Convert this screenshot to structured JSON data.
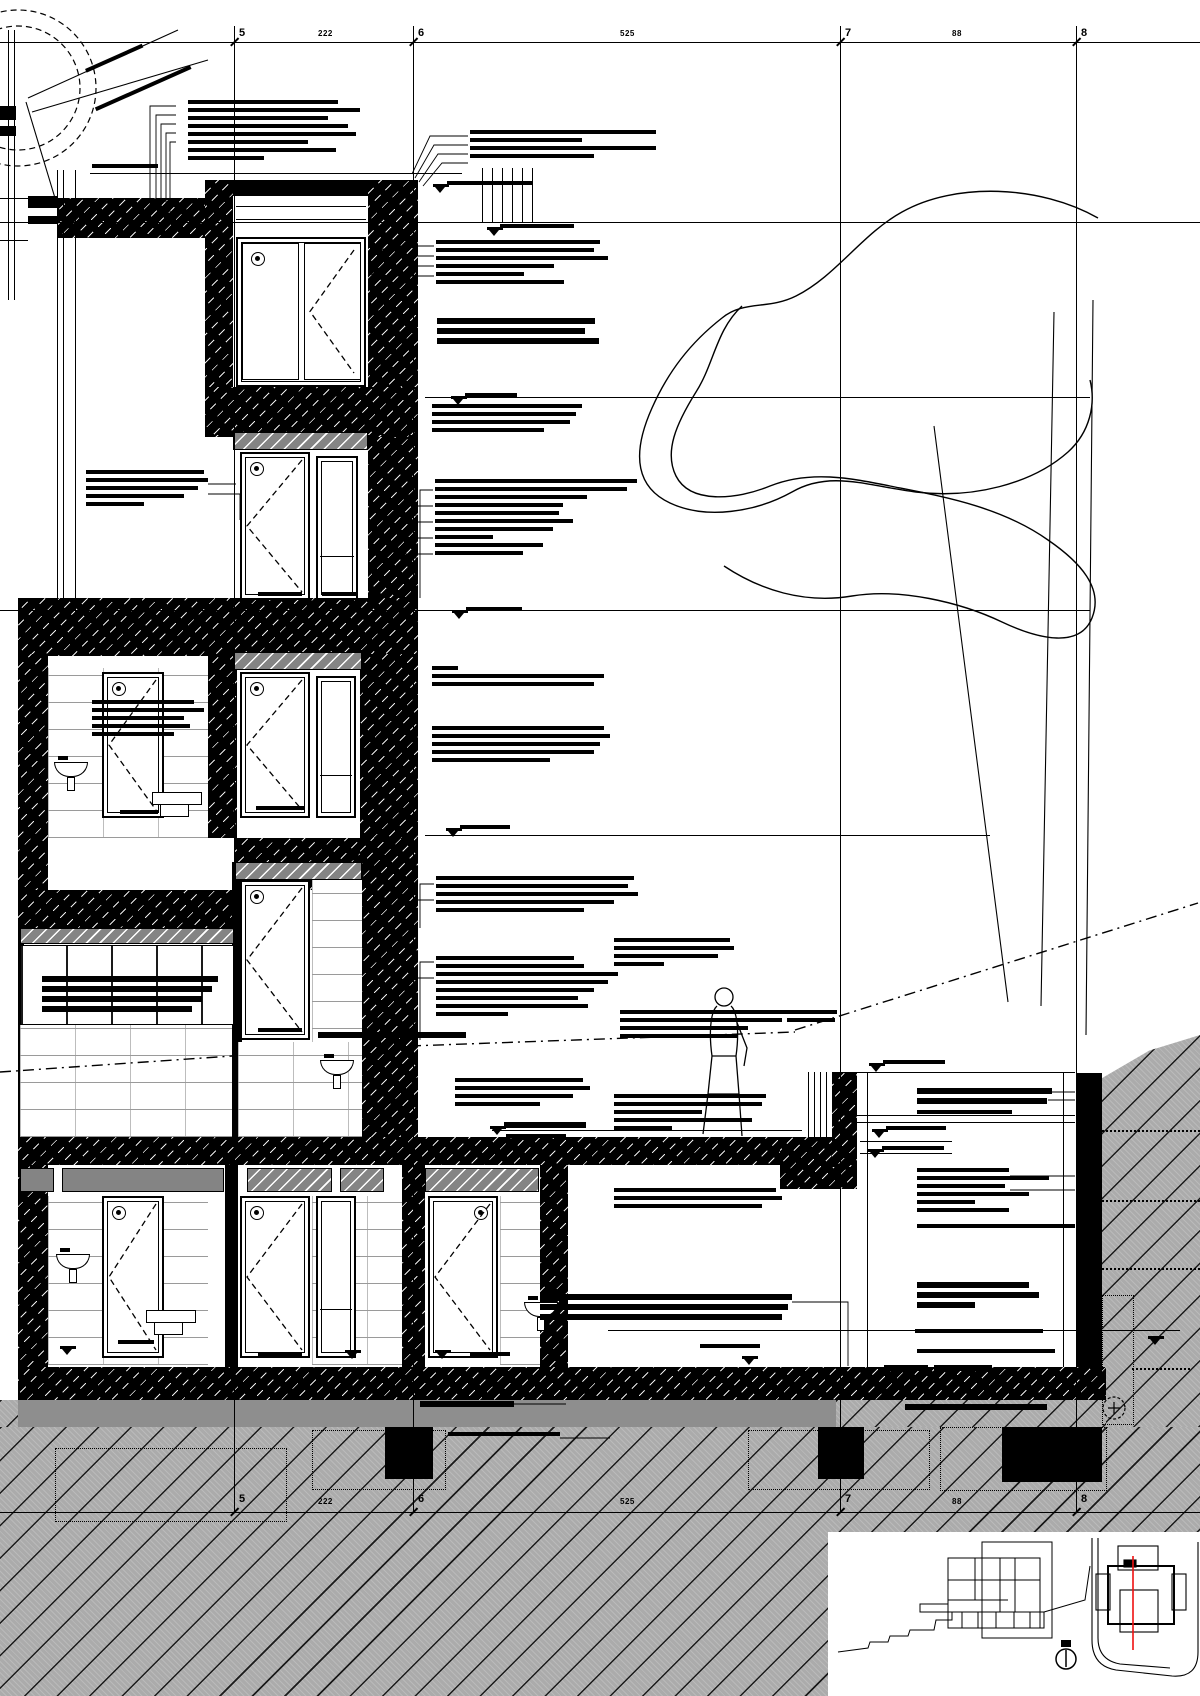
{
  "document": {
    "kind": "architectural building section detail drawing"
  },
  "colors": {
    "ink": "#000000",
    "paper": "#ffffff",
    "earth_grey": "#ababab",
    "band_grey": "#848484",
    "lean_grey": "#8e8e8e",
    "section_line_red": "#ee1111"
  },
  "grid": {
    "columns": [
      {
        "label": "5",
        "x": 234
      },
      {
        "label": "6",
        "x": 413
      },
      {
        "label": "7",
        "x": 840
      },
      {
        "label": "8",
        "x": 1076
      }
    ],
    "dimensions": {
      "top": [
        {
          "text": "222",
          "x": 318
        },
        {
          "text": "525",
          "x": 620
        },
        {
          "text": "88",
          "x": 952
        }
      ],
      "bottom": [
        {
          "text": "222",
          "x": 318
        },
        {
          "text": "525",
          "x": 620
        },
        {
          "text": "88",
          "x": 952
        }
      ]
    },
    "line_top_y": 26,
    "line_bottom_y": 1512,
    "dim_line_top_y": 42,
    "dim_line_bottom_y": 1512
  },
  "levels": {
    "lines": [
      [
        0,
        222,
        1200
      ],
      [
        425,
        397,
        665
      ],
      [
        0,
        610,
        1090
      ],
      [
        425,
        835,
        565
      ]
    ],
    "spots": [
      [
        433,
        184
      ],
      [
        487,
        227
      ],
      [
        451,
        396
      ],
      [
        452,
        610
      ],
      [
        446,
        828
      ],
      [
        490,
        1126
      ],
      [
        869,
        1063
      ],
      [
        872,
        1129
      ],
      [
        868,
        1149
      ],
      [
        742,
        1356
      ],
      [
        1148,
        1336
      ],
      [
        345,
        1350
      ],
      [
        435,
        1350
      ],
      [
        60,
        1346
      ]
    ]
  },
  "annotations": [
    {
      "x": 188,
      "y": 100,
      "w": [
        150,
        172,
        140,
        160,
        168,
        120,
        148,
        76
      ]
    },
    {
      "x": 92,
      "y": 164,
      "w": [
        66
      ]
    },
    {
      "x": 470,
      "y": 130,
      "w": [
        186,
        112,
        186,
        124
      ]
    },
    {
      "x": 447,
      "y": 181,
      "w": [
        86
      ]
    },
    {
      "x": 500,
      "y": 224,
      "w": [
        74
      ]
    },
    {
      "x": 436,
      "y": 240,
      "w": [
        164,
        158,
        172,
        118,
        88,
        128
      ]
    },
    {
      "x": 437,
      "y": 318,
      "w": [
        158,
        148,
        162
      ],
      "b": 1
    },
    {
      "x": 465,
      "y": 393,
      "w": [
        52
      ]
    },
    {
      "x": 432,
      "y": 404,
      "w": [
        150,
        144,
        138,
        112
      ]
    },
    {
      "x": 86,
      "y": 470,
      "w": [
        118,
        122,
        112,
        98,
        58
      ]
    },
    {
      "x": 435,
      "y": 479,
      "w": [
        202,
        192,
        152,
        128,
        124,
        138,
        118,
        58,
        108,
        88
      ]
    },
    {
      "x": 466,
      "y": 607,
      "w": [
        56
      ]
    },
    {
      "x": 432,
      "y": 666,
      "w": [
        26,
        172,
        162
      ]
    },
    {
      "x": 432,
      "y": 726,
      "w": [
        172,
        178,
        168,
        162,
        118
      ]
    },
    {
      "x": 92,
      "y": 700,
      "w": [
        102,
        112,
        92,
        98,
        82
      ]
    },
    {
      "x": 256,
      "y": 806,
      "w": [
        48
      ]
    },
    {
      "x": 120,
      "y": 810,
      "w": [
        38
      ]
    },
    {
      "x": 460,
      "y": 825,
      "w": [
        50
      ]
    },
    {
      "x": 436,
      "y": 876,
      "w": [
        198,
        192,
        202,
        178,
        148
      ]
    },
    {
      "x": 42,
      "y": 976,
      "w": [
        176,
        170,
        160,
        150
      ],
      "b": 1
    },
    {
      "x": 436,
      "y": 956,
      "w": [
        138,
        148,
        182,
        172,
        158,
        142,
        152,
        72
      ]
    },
    {
      "x": 614,
      "y": 938,
      "w": [
        116,
        120,
        104,
        50
      ]
    },
    {
      "x": 620,
      "y": 1010,
      "w": [
        168,
        162,
        128,
        118
      ]
    },
    {
      "x": 787,
      "y": 1010,
      "w": [
        50,
        48
      ]
    },
    {
      "x": 883,
      "y": 1060,
      "w": [
        62
      ]
    },
    {
      "x": 917,
      "y": 1088,
      "w": [
        135,
        130
      ],
      "b": 1
    },
    {
      "x": 917,
      "y": 1110,
      "w": [
        95
      ]
    },
    {
      "x": 886,
      "y": 1126,
      "w": [
        60
      ]
    },
    {
      "x": 882,
      "y": 1146,
      "w": [
        62
      ]
    },
    {
      "x": 917,
      "y": 1168,
      "w": [
        92,
        132,
        88,
        112,
        58,
        92
      ]
    },
    {
      "x": 917,
      "y": 1224,
      "w": [
        158
      ]
    },
    {
      "x": 917,
      "y": 1282,
      "w": [
        112,
        122,
        58
      ],
      "b": 1
    },
    {
      "x": 614,
      "y": 1094,
      "w": [
        152,
        148,
        88,
        138,
        58
      ]
    },
    {
      "x": 455,
      "y": 1078,
      "w": [
        128,
        135,
        118,
        85
      ]
    },
    {
      "x": 614,
      "y": 1188,
      "w": [
        162,
        168,
        148
      ]
    },
    {
      "x": 540,
      "y": 1294,
      "w": [
        252,
        248,
        242
      ],
      "b": 1
    },
    {
      "x": 915,
      "y": 1329,
      "w": [
        128
      ]
    },
    {
      "x": 917,
      "y": 1349,
      "w": [
        138
      ]
    },
    {
      "x": 884,
      "y": 1365,
      "w": [
        44
      ],
      "b": 1
    },
    {
      "x": 934,
      "y": 1365,
      "w": [
        58
      ],
      "b": 1
    },
    {
      "x": 420,
      "y": 1401,
      "w": [
        94
      ],
      "b": 1
    },
    {
      "x": 448,
      "y": 1432,
      "w": [
        112
      ]
    },
    {
      "x": 905,
      "y": 1404,
      "w": [
        142
      ],
      "b": 1
    },
    {
      "x": 504,
      "y": 1122,
      "w": [
        82
      ],
      "b": 1
    },
    {
      "x": 506,
      "y": 1134,
      "w": [
        60
      ]
    },
    {
      "x": 318,
      "y": 1032,
      "w": [
        148
      ],
      "b": 1
    },
    {
      "x": 84,
      "y": 56,
      "w": [
        62
      ],
      "rot": -24
    },
    {
      "x": 92,
      "y": 86,
      "w": [
        104
      ],
      "rot": -24
    },
    {
      "x": 258,
      "y": 592,
      "w": [
        44
      ]
    },
    {
      "x": 322,
      "y": 592,
      "w": [
        34
      ]
    },
    {
      "x": 258,
      "y": 1028,
      "w": [
        44
      ]
    },
    {
      "x": 258,
      "y": 1352,
      "w": [
        44
      ]
    },
    {
      "x": 118,
      "y": 1340,
      "w": [
        36
      ]
    },
    {
      "x": 470,
      "y": 1352,
      "w": [
        40
      ]
    },
    {
      "x": 700,
      "y": 1344,
      "w": [
        60
      ]
    }
  ],
  "structure": {
    "walls": [
      [
        57,
        198,
        148,
        40,
        1
      ],
      [
        205,
        180,
        213,
        16,
        0
      ],
      [
        205,
        180,
        28,
        257,
        1
      ],
      [
        368,
        180,
        50,
        257,
        1
      ],
      [
        205,
        387,
        213,
        48,
        1
      ],
      [
        368,
        437,
        50,
        175,
        1
      ],
      [
        18,
        598,
        400,
        58,
        1
      ],
      [
        18,
        654,
        30,
        236,
        1
      ],
      [
        208,
        654,
        29,
        184,
        1
      ],
      [
        360,
        654,
        58,
        184,
        1
      ],
      [
        235,
        838,
        183,
        52,
        1
      ],
      [
        18,
        890,
        220,
        38,
        1
      ],
      [
        360,
        838,
        58,
        299,
        1
      ],
      [
        232,
        862,
        10,
        275,
        0
      ],
      [
        18,
        928,
        6,
        209,
        0
      ],
      [
        18,
        1137,
        792,
        28,
        1
      ],
      [
        780,
        1137,
        77,
        52,
        1
      ],
      [
        832,
        1072,
        25,
        95,
        1
      ],
      [
        18,
        1165,
        30,
        202,
        1
      ],
      [
        225,
        1165,
        13,
        202,
        0
      ],
      [
        402,
        1165,
        23,
        202,
        1
      ],
      [
        540,
        1165,
        28,
        202,
        1
      ],
      [
        18,
        1367,
        1088,
        33,
        1
      ],
      [
        1076,
        1073,
        26,
        294,
        0
      ],
      [
        0,
        106,
        16,
        14,
        0
      ],
      [
        0,
        126,
        16,
        10,
        0
      ],
      [
        28,
        196,
        29,
        12,
        0
      ],
      [
        28,
        216,
        29,
        8,
        0
      ]
    ],
    "bands": [
      [
        233,
        432,
        133,
        16,
        "h"
      ],
      [
        233,
        652,
        127,
        16,
        "h"
      ],
      [
        20,
        928,
        212,
        14,
        "h"
      ],
      [
        235,
        862,
        125,
        16,
        "h"
      ],
      [
        20,
        1168,
        32,
        22,
        "p"
      ],
      [
        62,
        1168,
        160,
        22,
        "p"
      ],
      [
        247,
        1168,
        83,
        22,
        "h"
      ],
      [
        340,
        1168,
        42,
        22,
        "h"
      ],
      [
        425,
        1168,
        112,
        22,
        "h"
      ]
    ],
    "blockwork": [
      [
        48,
        668,
        160,
        170
      ],
      [
        312,
        880,
        50,
        257
      ],
      [
        238,
        1042,
        122,
        95
      ],
      [
        20,
        1023,
        212,
        114
      ],
      [
        48,
        1196,
        160,
        169
      ],
      [
        312,
        1196,
        90,
        169
      ],
      [
        500,
        1196,
        40,
        169
      ]
    ],
    "curtain": [
      [
        20,
        945,
        212,
        78
      ]
    ],
    "openings": [
      {
        "t": "win2",
        "x": 236,
        "y": 237,
        "w": 130,
        "h": 150
      },
      {
        "t": "door",
        "x": 240,
        "y": 452,
        "w": 70,
        "h": 148
      },
      {
        "t": "side",
        "x": 316,
        "y": 456,
        "w": 42,
        "h": 144
      },
      {
        "t": "door",
        "x": 102,
        "y": 672,
        "w": 62,
        "h": 146
      },
      {
        "t": "door",
        "x": 240,
        "y": 672,
        "w": 70,
        "h": 146
      },
      {
        "t": "side",
        "x": 316,
        "y": 676,
        "w": 40,
        "h": 142
      },
      {
        "t": "door",
        "x": 240,
        "y": 880,
        "w": 70,
        "h": 160
      },
      {
        "t": "door",
        "x": 102,
        "y": 1196,
        "w": 62,
        "h": 162
      },
      {
        "t": "door",
        "x": 240,
        "y": 1196,
        "w": 70,
        "h": 162
      },
      {
        "t": "side",
        "x": 316,
        "y": 1196,
        "w": 40,
        "h": 162
      },
      {
        "t": "door",
        "x": 428,
        "y": 1196,
        "w": 70,
        "h": 162,
        "lbl": "tr"
      }
    ],
    "fixtures": [
      {
        "t": "basin",
        "x": 54,
        "y": 756
      },
      {
        "t": "wc",
        "x": 152,
        "y": 792
      },
      {
        "t": "basin",
        "x": 320,
        "y": 1054
      },
      {
        "t": "basin",
        "x": 56,
        "y": 1248
      },
      {
        "t": "wc",
        "x": 146,
        "y": 1310
      },
      {
        "t": "basin",
        "x": 524,
        "y": 1296
      }
    ],
    "thin_h": [
      [
        0,
        198,
        57
      ],
      [
        0,
        240,
        28
      ],
      [
        90,
        173,
        372
      ],
      [
        236,
        206,
        130
      ],
      [
        236,
        219,
        130
      ],
      [
        857,
        1072,
        218
      ],
      [
        857,
        1115,
        218
      ],
      [
        857,
        1122,
        218
      ],
      [
        860,
        1141,
        92
      ],
      [
        860,
        1153,
        92
      ],
      [
        608,
        1330,
        572
      ],
      [
        492,
        1130,
        310
      ],
      [
        0,
        42,
        1200
      ],
      [
        0,
        1512,
        1200
      ]
    ],
    "thin_v": [
      [
        8,
        30,
        270
      ],
      [
        14,
        30,
        270
      ],
      [
        57,
        170,
        442
      ],
      [
        63,
        170,
        442
      ],
      [
        75,
        170,
        442
      ],
      [
        482,
        168,
        54
      ],
      [
        492,
        168,
        54
      ],
      [
        502,
        168,
        54
      ],
      [
        512,
        168,
        54
      ],
      [
        522,
        168,
        54
      ],
      [
        532,
        168,
        54
      ],
      [
        867,
        1072,
        295
      ],
      [
        1063,
        1072,
        295
      ],
      [
        808,
        1072,
        65
      ],
      [
        814,
        1072,
        65
      ],
      [
        820,
        1072,
        65
      ],
      [
        826,
        1072,
        65
      ]
    ]
  },
  "ground": {
    "earth": [
      [
        0,
        1427,
        1200,
        269,
        0
      ],
      [
        1102,
        1035,
        98,
        392,
        1
      ],
      [
        836,
        1400,
        270,
        27,
        0
      ],
      [
        0,
        1400,
        18,
        27,
        0
      ]
    ],
    "lean": [
      [
        18,
        1400,
        818,
        27
      ]
    ],
    "footings": [
      [
        385,
        1427,
        48,
        52
      ],
      [
        818,
        1427,
        46,
        52
      ],
      [
        1002,
        1427,
        100,
        55
      ]
    ],
    "dotted_rects": [
      [
        312,
        1430,
        132,
        58
      ],
      [
        55,
        1448,
        230,
        72
      ],
      [
        748,
        1430,
        180,
        58
      ],
      [
        940,
        1427,
        165,
        62
      ],
      [
        1102,
        1295,
        30,
        128
      ]
    ],
    "dotted_lines": [
      [
        1132,
        1368,
        58
      ],
      [
        1102,
        1130,
        98
      ],
      [
        1102,
        1200,
        98
      ],
      [
        1102,
        1268,
        98
      ]
    ]
  },
  "inset": {
    "x": 828,
    "y": 1532,
    "w": 372,
    "h": 164,
    "contents": [
      "overview-section-thumbnail",
      "site-plan-thumbnail",
      "north-arrow-icon",
      "red-section-cut-line"
    ]
  }
}
